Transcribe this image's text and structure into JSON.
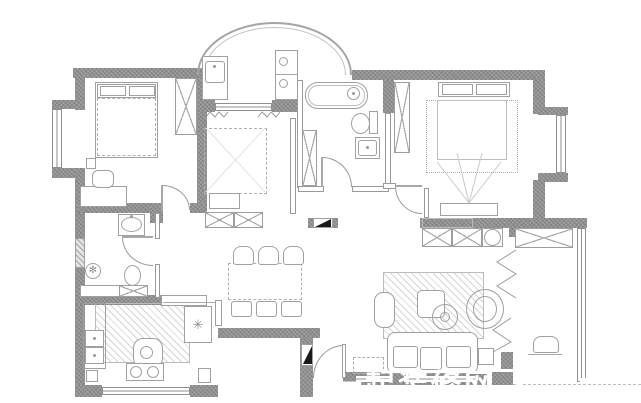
{
  "watermark": {
    "text": "一起装修网"
  },
  "icons": {
    "fridge_snowflake": "✳",
    "floor_drain": "✻"
  },
  "palette": {
    "bg": "#ffffff",
    "wall": "#8f8f8f",
    "wall_light": "#e4e4e4",
    "line": "#a0a0a0",
    "line_light": "#c4c4c4",
    "flue": "#1a1a1a",
    "watermark": "#ffffff"
  }
}
